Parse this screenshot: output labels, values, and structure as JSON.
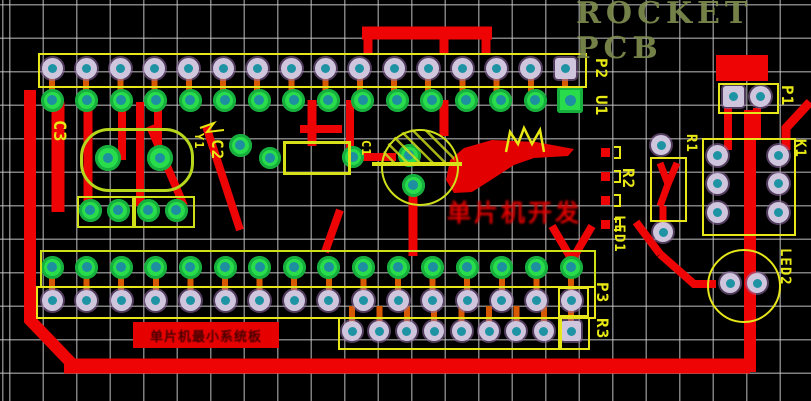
{
  "brand": {
    "watermark": "ROCKET PCB"
  },
  "overlays": {
    "red_watermark_text": "单片机开发",
    "bottom_label_text": "单片机最小系统板"
  },
  "components": {
    "c3": "C3",
    "y1": "Y1",
    "c2": "C2",
    "c1": "C1",
    "p2": "P2",
    "u1": "U1",
    "r2": "R2",
    "led1": "LED1",
    "r1": "R1",
    "p1": "P1",
    "k1": "K1",
    "led2": "LED2",
    "p3": "P3",
    "r3": "R3"
  },
  "connectors": {
    "top_header_pin_count": 16,
    "top_socket_row_pin_count": 16,
    "bottom_socket_row_pin_count": 16,
    "bottom_header_pin_count": 16,
    "aux_header_pin_count": 9,
    "switch_pad_count": 6,
    "p1_pin_count": 2,
    "led_pad_count": 2
  },
  "colors": {
    "background": "#000000",
    "grid": "#cdcdcd",
    "trace_red": "#ee0404",
    "silkscreen_yellow": "#e8e815",
    "silkscreen_yellow_green": "#bfdb1c",
    "pad_green": "#28dc4b",
    "pad_ring_lavender": "#cfc5dc",
    "pad_center_teal": "#1e93a4",
    "stub_orange": "#d85a00",
    "brand_olive": "#7d8c4f"
  }
}
